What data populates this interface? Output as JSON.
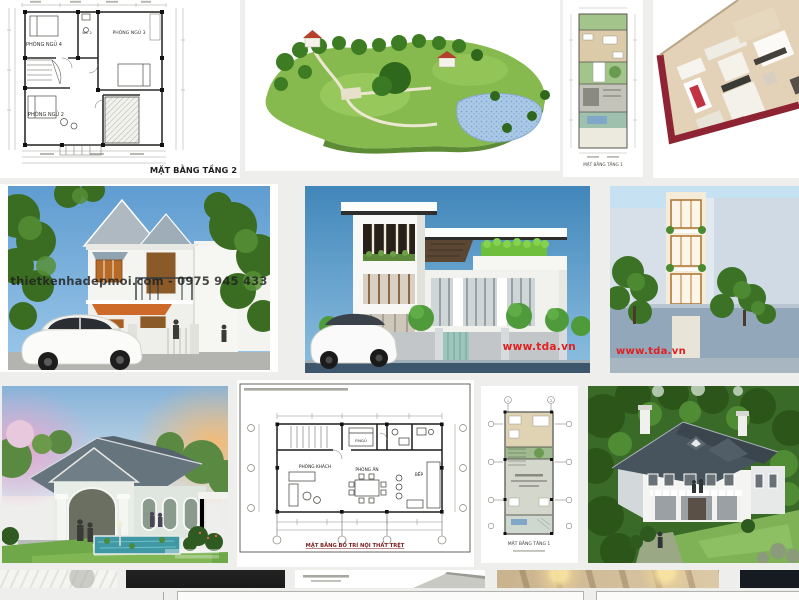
{
  "page": {
    "background": "#eeeeec",
    "description_colors": {
      "watermark_red": "#e21f1f",
      "caption_dark": "#1f1f1f",
      "plan_caption_red": "#7a1f1f"
    }
  },
  "results": {
    "floorplan_tang2": {
      "caption": "MẶT BẰNG TẦNG 2",
      "rooms": {
        "bedroom4": "PHÒNG NGỦ 4",
        "wc": "WC 2",
        "bedroom3": "PHÒNG NGỦ 3",
        "bedroom2": "PHÒNG NGỦ 2"
      }
    },
    "narrow_plan_top": {
      "caption": "MẶT BẰNG TẦNG 1"
    },
    "house_street_render": {
      "watermark": "thietkenhadepmoi.com - 0975 945 433"
    },
    "modern_villa_render": {
      "watermark": "www.tda.vn"
    },
    "tube_house_render": {
      "watermark": "www.tda.vn"
    },
    "interior_floor_plan": {
      "caption": "MẶT BẰNG BỐ TRÍ NỘI THẤT TRỆT",
      "rooms": {
        "living": "PHÒNG KHÁCH",
        "dining": "PHÒNG ĂN",
        "kitchen": "BẾP",
        "bedroom": "P.NGỦ"
      }
    },
    "narrow_plan_bottom": {
      "caption": "MẶT BẰNG TẦNG 1"
    }
  }
}
